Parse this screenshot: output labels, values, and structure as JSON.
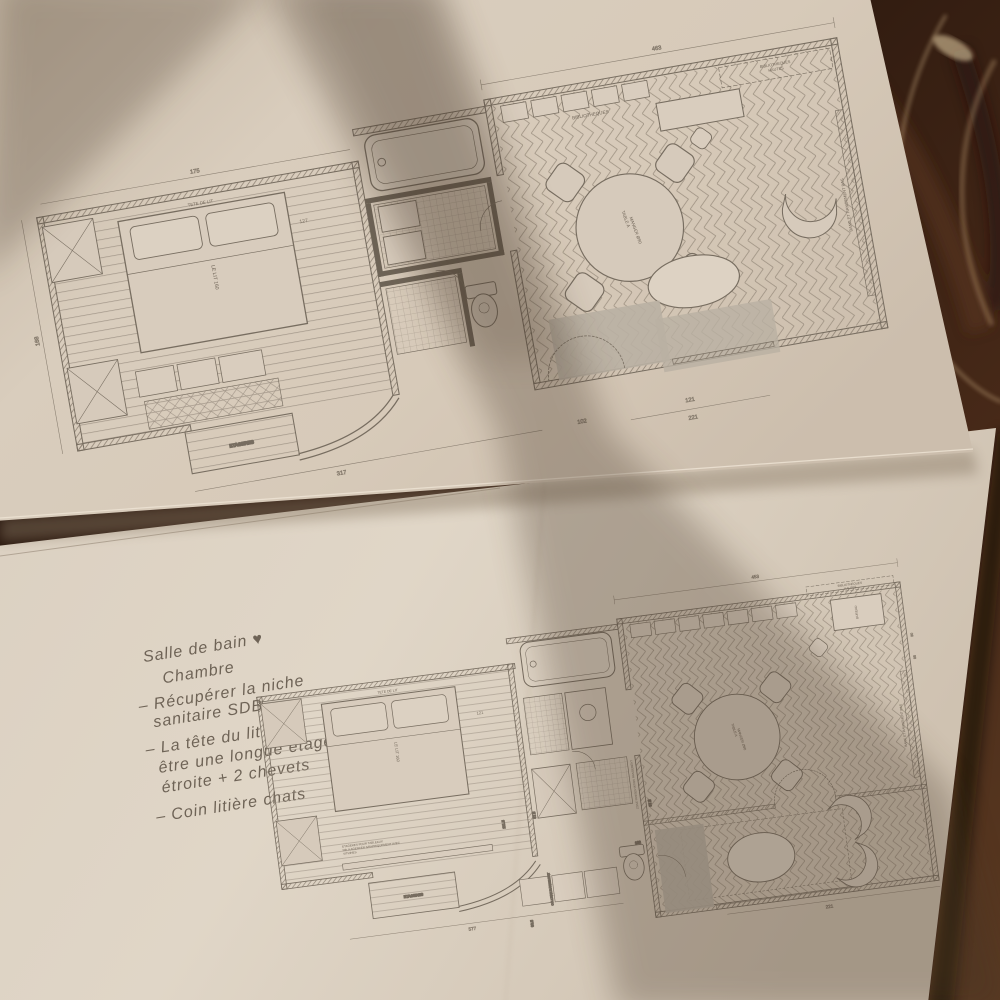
{
  "colors": {
    "paper": "#d6cabb",
    "paper_shadow": "#b0a291",
    "ink": "#6e6356",
    "wall_dark": "#6e6457",
    "wood_dark": "#1c0f09",
    "wood_mid": "#45281a",
    "wood_light": "#5a3a22",
    "sofa_gray": "#b9b0a3"
  },
  "top_plan": {
    "labels": {
      "bibliotheques": "BIBLIOTHEQUES",
      "bibliotheques_hautes_1": "BIBLIOTHEQUES",
      "bibliotheques_hautes_2": "HAUTES",
      "tete_de_lit": "TETE DE LIT",
      "lit": "LE LIT 160",
      "table_1": "TABLE A",
      "table_2": "MANGER Ø90",
      "banc": "BANC ET RANGEMENT BAS",
      "etageres": "ETAGERES"
    },
    "dims": {
      "top": "463",
      "top_left": "175",
      "left": "168",
      "over_bed": "127",
      "bottom_left": "317",
      "bottom_center": "102",
      "bottom_right": "221",
      "bottom_right2": "121"
    }
  },
  "bottom_plan": {
    "labels": {
      "tete_de_lit": "TETE DE LIT",
      "lit": "LE LIT 160",
      "note_1": "ETAGERES POUR TABLEAUX",
      "note_2": "NB: A AGENCER GRAPHIQUEMENT AVEC",
      "note_3": "VITRINES",
      "table_1": "TABLE A",
      "table_2": "MANGER Ø90",
      "bibliotheques_hautes_1": "BIBLIOTHEQUES",
      "bibliotheques_hautes_2": "HAUTES",
      "bureau": "BUREAU",
      "banc": "BANC ET RANGEMENT BAS",
      "banc2": "BANC ET RANGEMENT BAS",
      "colonne": "COLONNE RANGEMENT",
      "zone": "ZONE PRESENTATION RANGEMENT",
      "etageres": "ETAGERES"
    },
    "dims": {
      "top": "453",
      "over_bed": "121",
      "v1": "111.5",
      "v2": "87.5",
      "v3": "97.5",
      "v4": "60.5",
      "wc": "102",
      "bottom": "577",
      "bottom_right": "221",
      "r1": "30",
      "r2": "85"
    }
  },
  "notes": {
    "lines": [
      "Salle de bain ♥",
      "Chambre",
      "– Récupérer la niche",
      "sanitaire SDB",
      "– La tête du lit peut",
      "être une longue étagère",
      "étroite + 2 chevets",
      "– Coin litière chats"
    ]
  }
}
